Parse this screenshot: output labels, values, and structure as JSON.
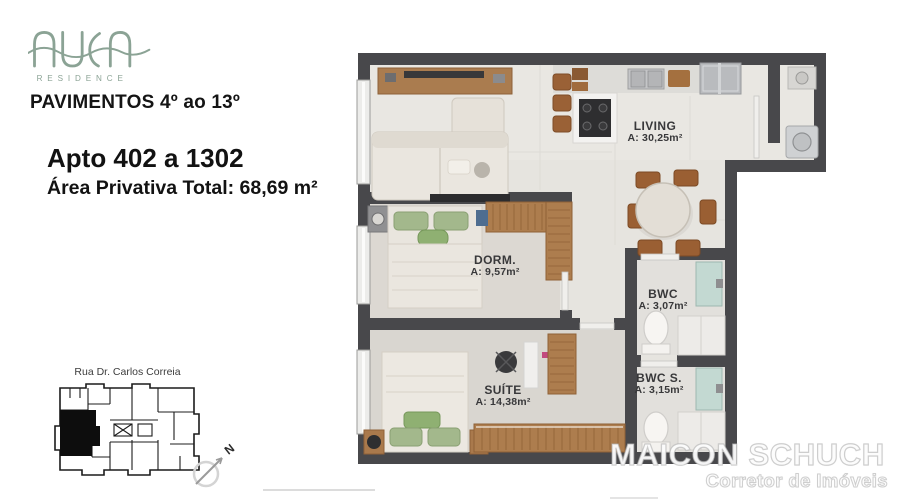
{
  "brand": {
    "logo_text": "AURA",
    "logo_subtext": "RESIDENCE",
    "pavimentos": "PAVIMENTOS 4º ao 13º"
  },
  "unit": {
    "title": "Apto 402 a 1302",
    "area_total": "Área Privativa Total: 68,69 m²"
  },
  "keyplan": {
    "street": "Rua Dr. Carlos Correia",
    "north_label": "N"
  },
  "floorplan": {
    "rooms": [
      {
        "name": "LIVING",
        "area": "A: 30,25m²"
      },
      {
        "name": "DORM.",
        "area": "A: 9,57m²"
      },
      {
        "name": "BWC",
        "area": "A: 3,07m²"
      },
      {
        "name": "BWC S.",
        "area": "A: 3,15m²"
      },
      {
        "name": "SUÍTE",
        "area": "A: 14,38m²"
      }
    ]
  },
  "watermark": {
    "name": "MAICON SCHUCH",
    "role": "Corretor de Imóveis"
  },
  "colors": {
    "brand_green": "#8ba395",
    "wall": "#48484b",
    "floor_light": "#e9e7e2",
    "floor_bedroom": "#dbd7d1",
    "wood": "#ad7d4e",
    "accent_pillow": "#a3b88c",
    "watermark_outline": "#b5b5b5"
  }
}
